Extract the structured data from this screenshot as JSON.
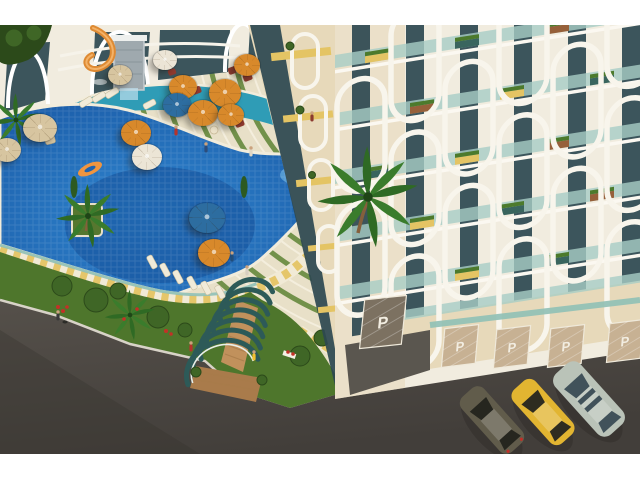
{
  "meta": {
    "title": "Seaside resort complex — aerial architectural render",
    "description": "Aerial 3D rendering of a residential resort: free-form blue swimming pool with palm islands and an orange float, terraced sun deck with parasols and loungers, white apartment towers with arched balcony frames and planted balconies, an arched pergola stair entrance, landscaped gardens, garage doors marked with P, and three cars parked on a dark asphalt street."
  },
  "canvas": {
    "width": 640,
    "height": 480,
    "scene_top": 25,
    "scene_bottom": 454,
    "background": "#ffffff"
  },
  "palette": {
    "deck_cream": "#e8e0c8",
    "terrace_green": "#5d8334",
    "pool_blue": "#1e6fbe",
    "pool_blue_deep": "#144f97",
    "pool_blue_light": "#6fb3e2",
    "pool_teal": "#2f9cb6",
    "grass": "#4e762c",
    "foliage": "#3f6626",
    "foliage_dark": "#2c4a1a",
    "flower_red": "#c23127",
    "road": "#504c47",
    "road_dark": "#413d39",
    "curb": "#d8d3c8",
    "facade_white": "#f1ecdf",
    "facade_cream": "#e7d9ba",
    "glass_dark": "#2c4850",
    "balcony_glass": "#a8cdc6",
    "accent_yellow": "#e4c464",
    "planter_brown": "#96603a",
    "planter_teal": "#39655e",
    "arch_teal": "#2d5a58",
    "wood": "#c1915c",
    "wood_dark": "#a97b4b",
    "stone": "#9fa9ae",
    "slide_orange": "#de8a33",
    "umbrella_orange": "#d8892b",
    "umbrella_blue": "#2d6da0",
    "umbrella_tan": "#d7c5a0",
    "umbrella_white": "#ece5d6",
    "seat_red": "#8f3a2f",
    "door_tan": "#c7b193",
    "door_dark": "#7c7161",
    "door_text": "#f2ede1"
  },
  "parking": {
    "label": "P",
    "door_count": 5
  },
  "cars": [
    {
      "name": "sedan-dark-olive",
      "body": "#615c4b",
      "window": "#26261f"
    },
    {
      "name": "sedan-yellow",
      "body": "#e2b531",
      "window": "#2e2c20"
    },
    {
      "name": "wagon-silver-green",
      "body": "#bac3b8",
      "window": "#41525a"
    }
  ],
  "umbrellas": [
    {
      "x": 40,
      "y": 128,
      "r": 17,
      "color": "tan"
    },
    {
      "x": 7,
      "y": 150,
      "r": 14,
      "color": "tan"
    },
    {
      "x": 120,
      "y": 75,
      "r": 12,
      "color": "tan"
    },
    {
      "x": 165,
      "y": 60,
      "r": 12,
      "color": "white"
    },
    {
      "x": 247,
      "y": 65,
      "r": 13,
      "color": "orange"
    },
    {
      "x": 183,
      "y": 87,
      "r": 14,
      "color": "orange"
    },
    {
      "x": 225,
      "y": 93,
      "r": 16,
      "color": "orange"
    },
    {
      "x": 177,
      "y": 105,
      "r": 14,
      "color": "blue"
    },
    {
      "x": 203,
      "y": 113,
      "r": 15,
      "color": "orange"
    },
    {
      "x": 231,
      "y": 115,
      "r": 13,
      "color": "orange"
    },
    {
      "x": 136,
      "y": 133,
      "r": 15,
      "color": "orange"
    },
    {
      "x": 147,
      "y": 157,
      "r": 15,
      "color": "white"
    },
    {
      "x": 207,
      "y": 218,
      "r": 18,
      "color": "blue"
    },
    {
      "x": 214,
      "y": 253,
      "r": 16,
      "color": "orange"
    }
  ],
  "counts": {
    "cars": 3,
    "umbrellas": 14,
    "garage_doors": 5
  }
}
